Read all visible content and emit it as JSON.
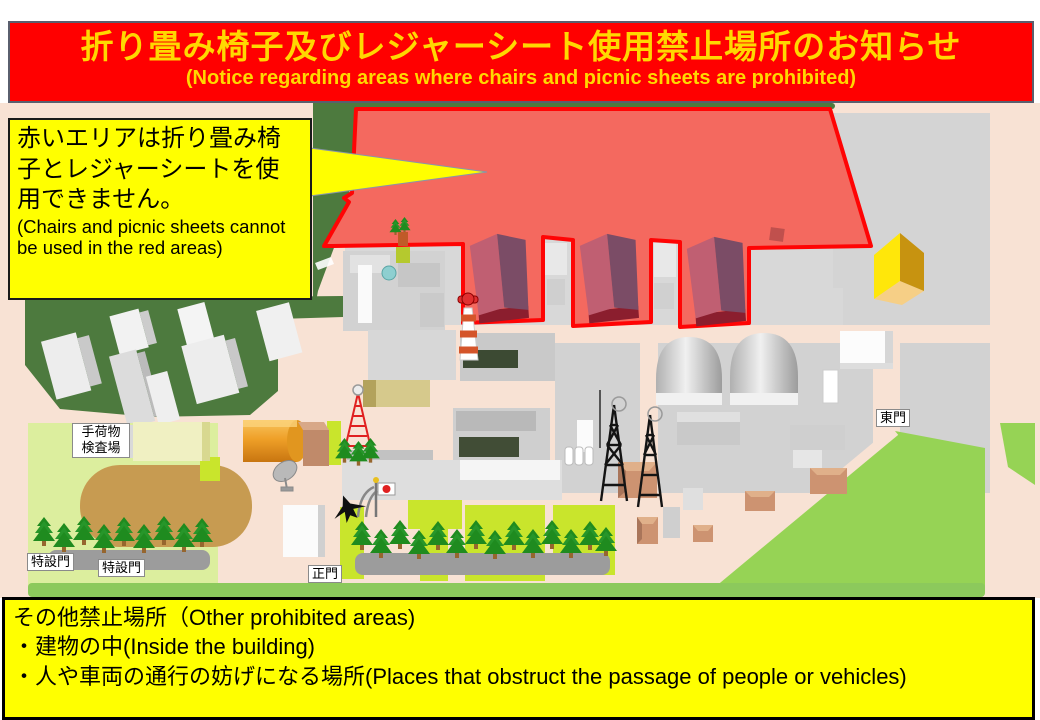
{
  "banner": {
    "title_jp": "折り畳み椅子及びレジャーシート使用禁止場所のお知らせ",
    "subtitle_en": "(Notice regarding areas where chairs and picnic sheets are prohibited)",
    "bg_color": "#ff0000",
    "text_color": "#ffd800"
  },
  "callout": {
    "jp": "赤いエリアは折り畳み椅子とレジャーシートを使用できません。",
    "en": "(Chairs and picnic sheets cannot be used in the red areas)",
    "bg_color": "#ffff00"
  },
  "map": {
    "prohibited_area_fill": "#f4695f",
    "prohibited_area_stroke": "#ff0404",
    "labels": {
      "baggage_line1": "手荷物",
      "baggage_line2": "検査場",
      "special_gate_1": "特設門",
      "special_gate_2": "特設門",
      "main_gate": "正門",
      "east_gate": "東門"
    }
  },
  "footer": {
    "line1": "その他禁止場所（Other prohibited areas)",
    "line2": "・建物の中(Inside the building)",
    "line3": "・人や車両の通行の妨げになる場所(Places that obstruct the passage of people or vehicles)"
  }
}
